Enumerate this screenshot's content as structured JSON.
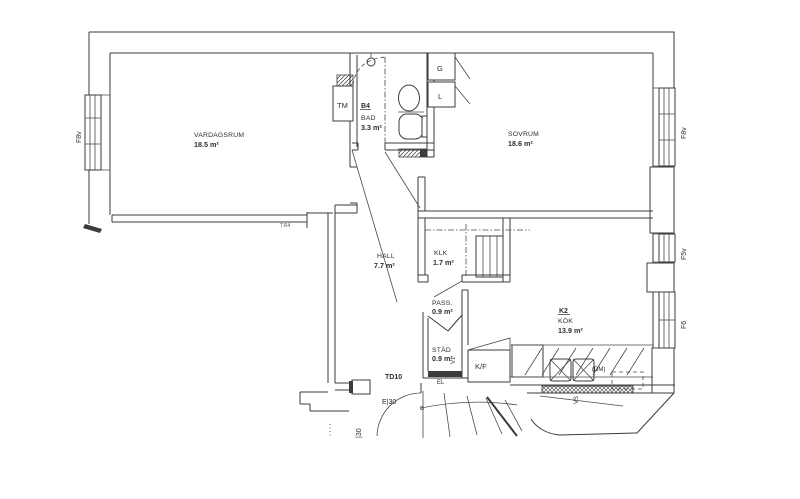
{
  "colors": {
    "line": "#3b3b3b",
    "background": "#ffffff"
  },
  "rooms": {
    "vardagsrum": {
      "name": "VARDAGSRUM",
      "area": "18.5 m²"
    },
    "sovrum": {
      "name": "SOVRUM",
      "area": "18.6 m²"
    },
    "bad": {
      "code": "B4",
      "name": "BAD",
      "area": "3.3 m²"
    },
    "hall": {
      "name": "HALL",
      "area": "7.7 m²"
    },
    "klk": {
      "name": "KLK",
      "area": "1.7 m²"
    },
    "pass": {
      "name": "PASS.",
      "area": "0.9 m²"
    },
    "stad": {
      "name": "STÄD",
      "area": "0.9 m²"
    },
    "kok": {
      "code": "K2",
      "name": "KÖK",
      "area": "13.9 m²"
    }
  },
  "closets": {
    "tm": "TM",
    "g": "G",
    "l": "L"
  },
  "appliances": {
    "kf": "K/F",
    "dm": "(DM)"
  },
  "shafts": {
    "v1": "V1",
    "vs": "VS",
    "el": "EL"
  },
  "windows": {
    "left_f8v": "F8v",
    "right_f8v": "F8v",
    "f5v": "F5v",
    "f6": "F6"
  },
  "doors": {
    "td10": "TD10"
  },
  "fire_ratings": {
    "e30": "E|30",
    "i30": "|30"
  },
  "annotations": {
    "wall_note": "T.R4"
  }
}
